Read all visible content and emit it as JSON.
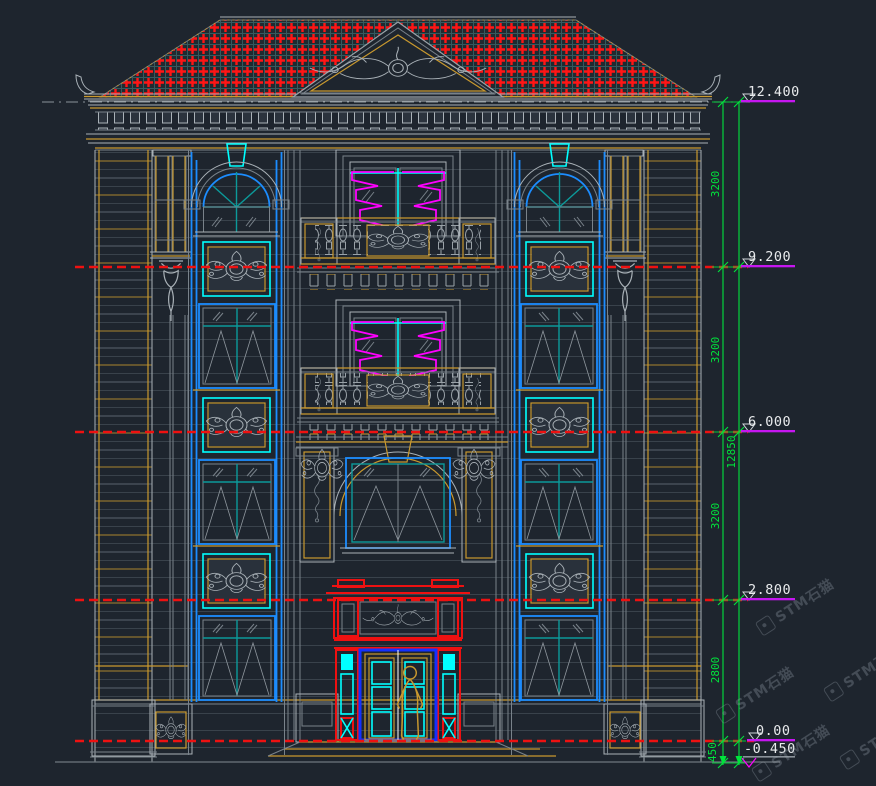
{
  "colors": {
    "background": "#1e252e",
    "wall_line": "#39424b",
    "gray": "#a9b1b7",
    "dim_gray": "#79828a",
    "gold": "#c9992e",
    "red": "#ee1111",
    "green": "#00e43c",
    "cyan": "#00ffff",
    "blue": "#1c8dff",
    "deep_blue": "#1231ff",
    "teal": "#0c9a9a",
    "magenta": "#ff00ff",
    "violet": "#c516f0",
    "white": "#e8eaec",
    "watermark": "rgba(158,168,180,0.30)"
  },
  "levels": [
    {
      "label": "12.400"
    },
    {
      "label": "9.200"
    },
    {
      "label": "6.000"
    },
    {
      "label": "2.800"
    },
    {
      "label": "0.00"
    },
    {
      "label": "-0.450"
    }
  ],
  "dimension": {
    "segments": [
      "3200",
      "3200",
      "3200",
      "2800",
      "450"
    ],
    "total": "12850"
  },
  "watermark": {
    "text": "STM石猫",
    "logo_icon": "stm-stone-cat-logo"
  }
}
